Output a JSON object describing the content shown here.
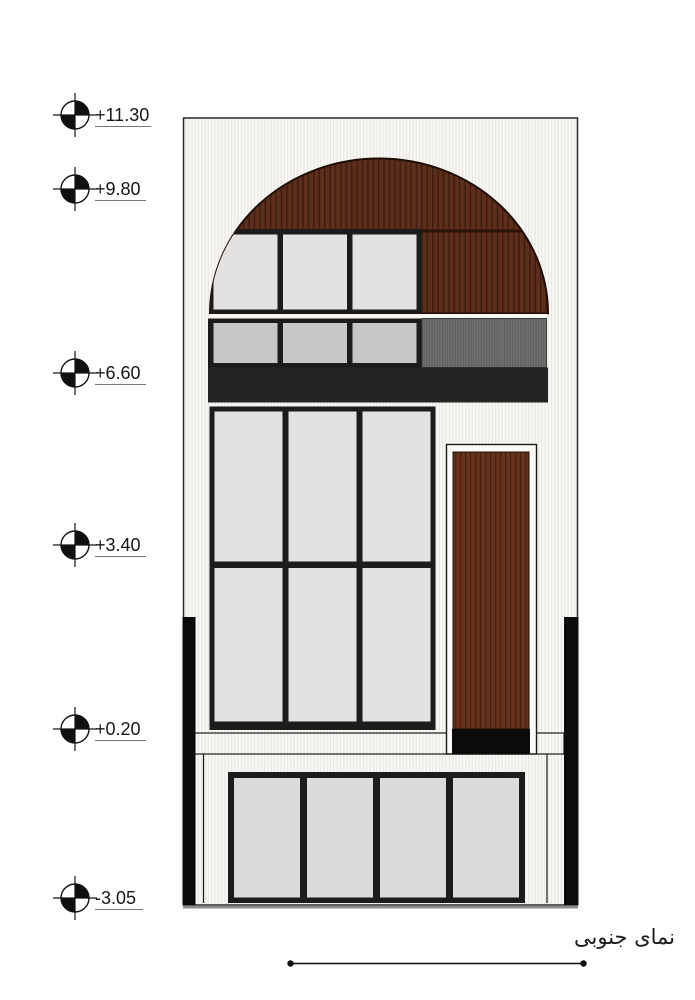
{
  "drawing": {
    "caption": "نمای جنوبی",
    "levels": [
      {
        "label": "+11.30"
      },
      {
        "label": "+9.80"
      },
      {
        "label": "+6.60"
      },
      {
        "label": "+3.40"
      },
      {
        "label": "+0.20"
      },
      {
        "label": "-3.05"
      }
    ],
    "colors": {
      "ink": "#141414",
      "frame": "#1c1c1c",
      "wall_bg": "#f8f7f4",
      "wall_stripe": "#e8e6e1",
      "wood_base": "#5c2e1b",
      "wood_stripe": "#3d1d0e",
      "door_base": "#66321c",
      "door_stripe": "#45210f",
      "slat_base": "#6f6f6f",
      "slat_stripe": "#5e5e5e",
      "band": "#242424",
      "glass_light": "#e3e2e0",
      "glass_mid": "#c8c7c5",
      "glass_basement": "#dcdbd9",
      "bar_black": "#0b0b0b",
      "ground": "#8d8d8d",
      "gap_white": "#f7f6f3"
    }
  }
}
